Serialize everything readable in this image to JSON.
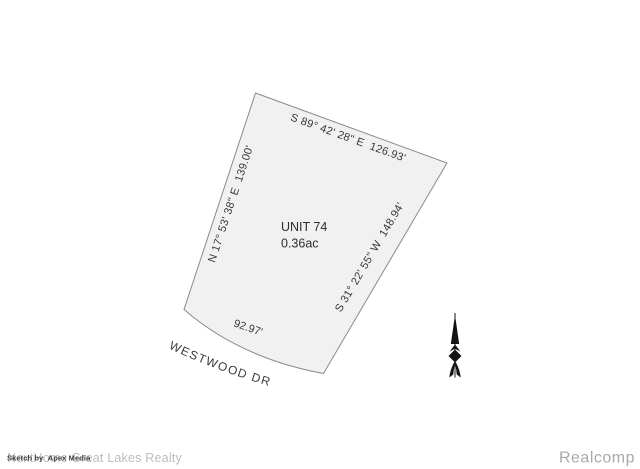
{
  "drawing": {
    "parcel": {
      "unit": "UNIT 74",
      "area": "0.36ac",
      "fill": "#f1f1f1",
      "outline_color": "#8a8a8a",
      "bearings": {
        "top": "S 89° 42' 28\" E  126.93'",
        "left": "N 17° 53' 38\" E  139.00'",
        "right": "S 31° 22' 55\" W  148.94'"
      },
      "frontage": "92.97'",
      "street": "WESTWOOD DR"
    },
    "north_arrow": {
      "icon": "north-arrow",
      "color": "#141414"
    }
  },
  "watermarks": {
    "realty": {
      "text": "NextHome Great Lakes Realty",
      "color": "#bdbdbd"
    },
    "credit": {
      "text": "Sketch by  Apex Media",
      "color": "#3d3d3d"
    },
    "brand": {
      "text": "Realcomp",
      "color": "#a9a9a9"
    }
  }
}
